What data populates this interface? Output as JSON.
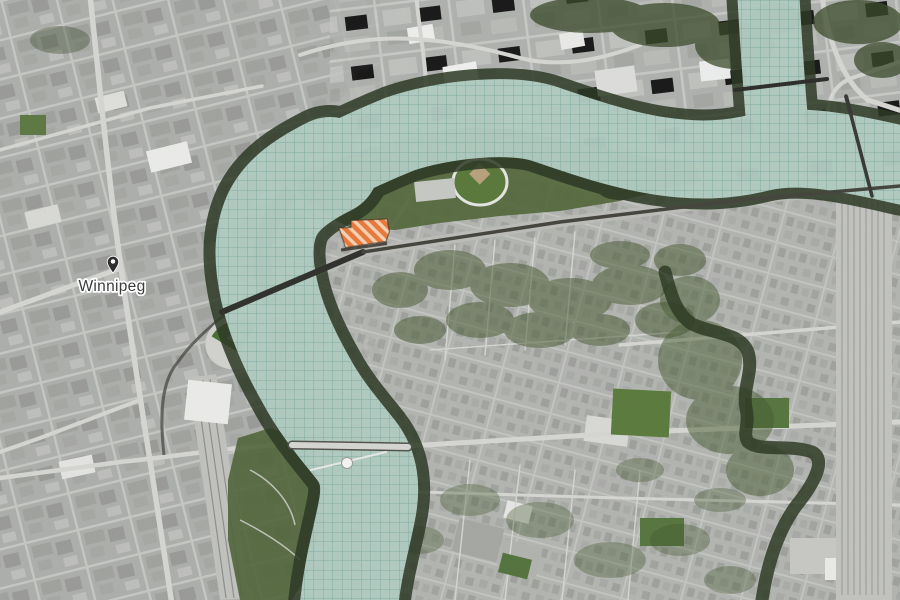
{
  "page": {
    "title": "Winnipeg aerial site map"
  },
  "map": {
    "city_label": "Winnipeg",
    "marker": {
      "icon": "location-pin",
      "label": "Winnipeg"
    },
    "site": {
      "label": "highlighted development site",
      "style": "diagonal-hatch"
    },
    "colors": {
      "base": "#b6b8b5",
      "river_overlay": "#cbe8df",
      "river_grid_line": "#6fa095",
      "bank_trees": "#2e3a26",
      "vegetation": "#55683c",
      "site_stripe": "#e87a3e",
      "site_stripe_light": "#f6d2b2",
      "road": "#d6d7d3",
      "rail": "#45453f",
      "label_text": "#3b3b3b"
    }
  }
}
